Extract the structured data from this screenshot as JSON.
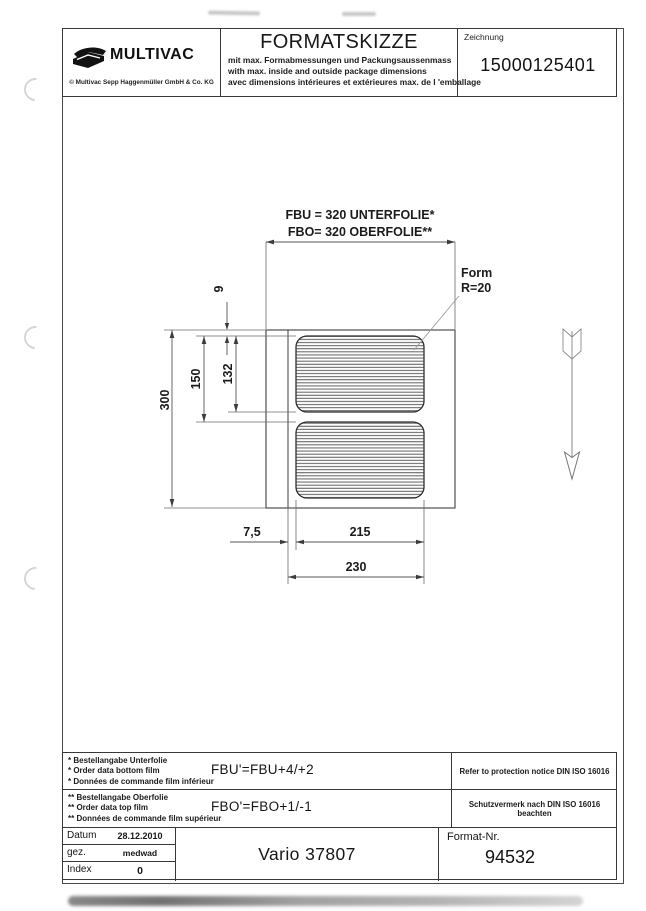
{
  "header": {
    "logo": {
      "brand": "MULTIVAC",
      "copyright": "© Multivac Sepp Haggenmüller GmbH & Co. KG"
    },
    "title": "FORMATSKIZZE",
    "subtitles": {
      "de": "mit max. Formabmessungen und Packungsaussenmass",
      "en": "with max. inside and outside package dimensions",
      "fr": "avec dimensions intérieures et extérieures max. de l 'emballage"
    },
    "drawing_no": {
      "label": "Zeichnung",
      "value": "15000125401"
    }
  },
  "drawing": {
    "film_label_bottom": "FBU = 320 UNTERFOLIE*",
    "film_label_top": "FBO= 320 OBERFOLIE**",
    "form_radius": {
      "line1": "Form",
      "line2": "R=20"
    },
    "dims": {
      "web_advance": "300",
      "pitch": "150",
      "cavity_length": "132",
      "top_margin": "9",
      "side_margin": "7,5",
      "cavity_width": "215",
      "format_width": "230"
    }
  },
  "footer": {
    "bottom_film_note": {
      "de": "* Bestellangabe Unterfolie",
      "en": "* Order data bottom film",
      "fr": "* Données de commande film inférieur",
      "formula": "FBU'=FBU+4/+2"
    },
    "top_film_note": {
      "de": "** Bestellangabe Oberfolie",
      "en": "** Order data top film",
      "fr": "** Données de commande film supérieur",
      "formula": "FBO'=FBO+1/-1"
    },
    "protection_notice_en": "Refer to protection notice DIN ISO 16016",
    "protection_notice_de": "Schutzvermerk nach DIN ISO 16016 beachten",
    "title_block": {
      "date_label": "Datum",
      "date_value": "28.12.2010",
      "drawn_label": "gez.",
      "drawn_value": "medwad",
      "index_label": "Index",
      "index_value": "0",
      "machine_model": "Vario 37807",
      "format_no_label": "Format-Nr.",
      "format_no_value": "94532"
    }
  }
}
